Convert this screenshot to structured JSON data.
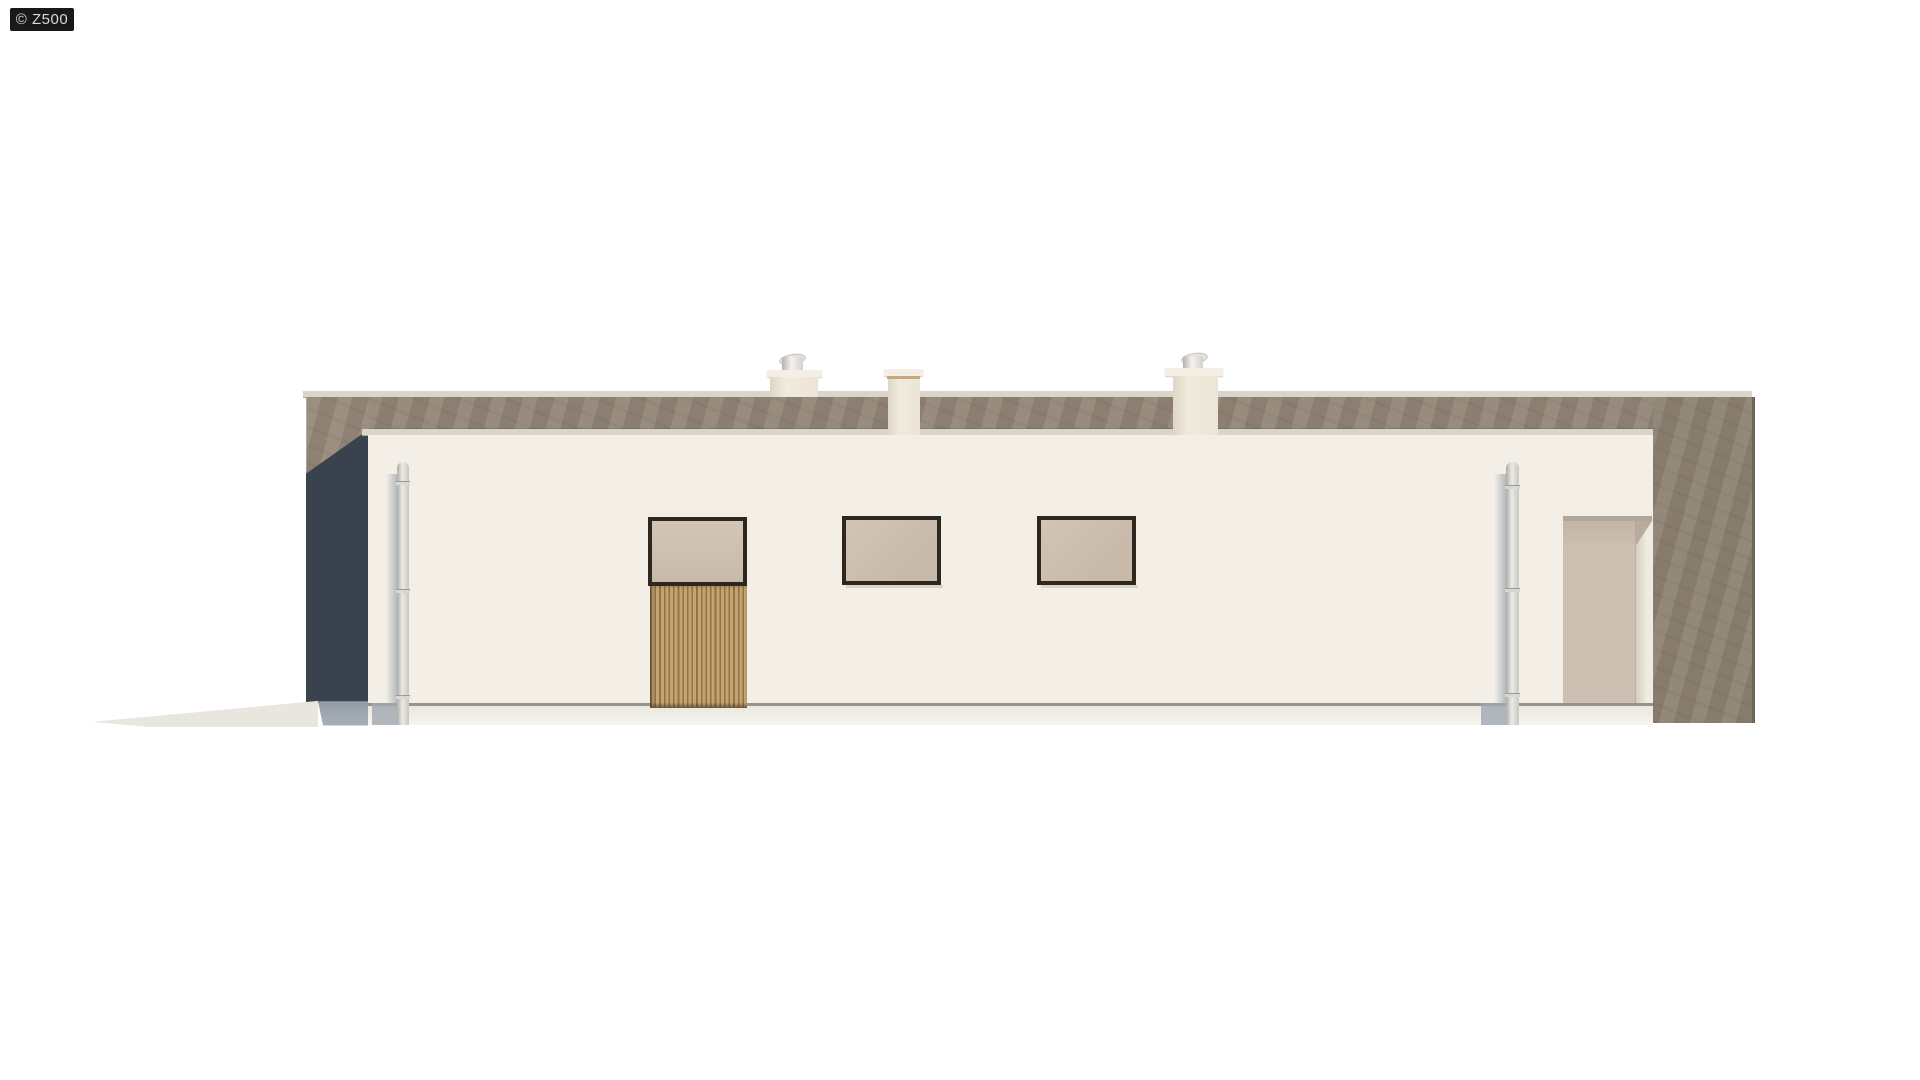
{
  "watermark": {
    "text": "© Z500"
  },
  "palette": {
    "page_bg": "#ffffff",
    "badge_bg": "#191919",
    "badge_fg": "#d6dae0",
    "rear_wall": "#8e8273",
    "rear_band": "#938678",
    "rear_shadow": "#39424d",
    "coping": "#dad5c9",
    "facade": "#f3efe6",
    "base_line": "#9a938a",
    "frame_dark": "#2e271e",
    "glazing": "#cbbdaf",
    "wood_light": "#c6a36f",
    "wood_dark": "#8f7448",
    "door_panel": "#cdbfb1",
    "pipe_light": "#eceae4",
    "pipe_shadow": "#a3abb4",
    "ground_wedge": "#e8e6de",
    "chimney_under": "#c9a87e"
  }
}
